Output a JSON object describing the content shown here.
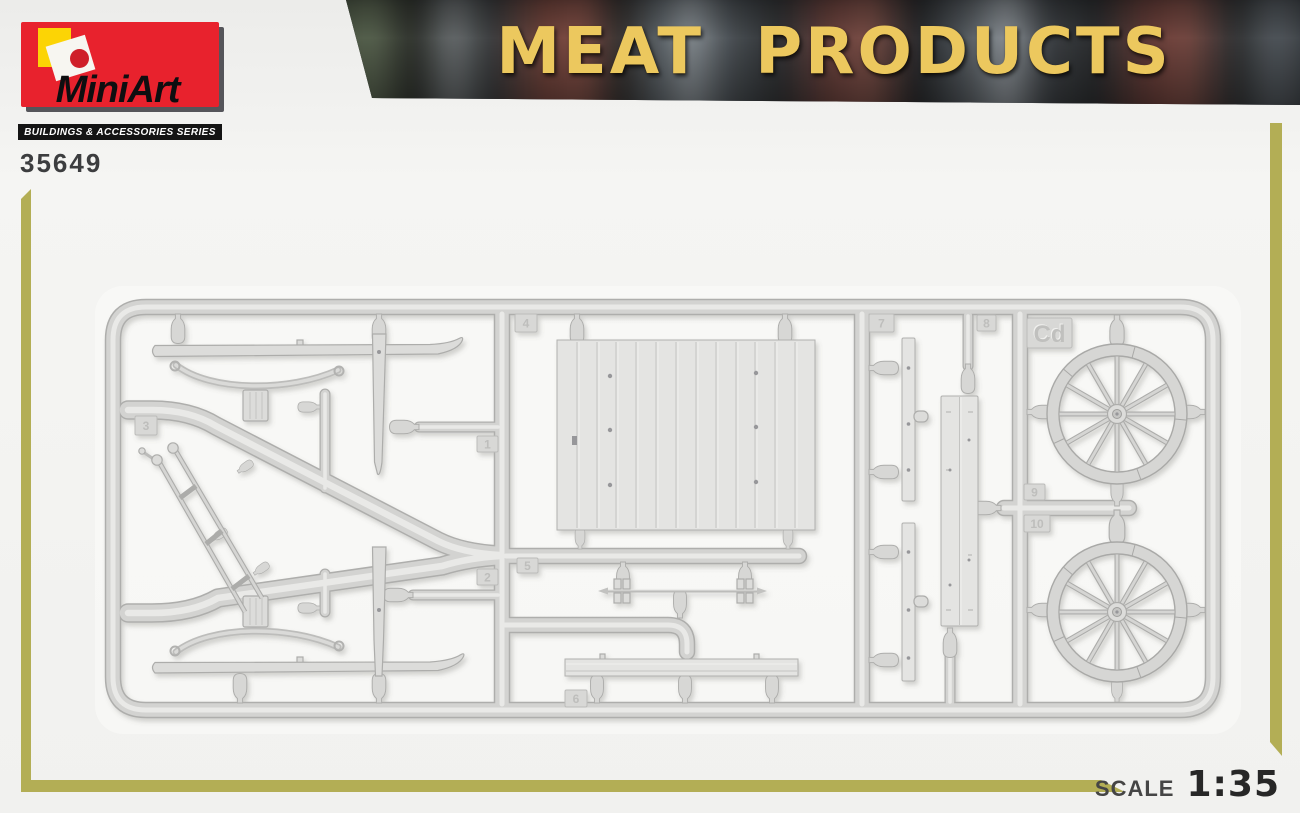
{
  "brand": {
    "name": "MiniArt",
    "series": "BUILDINGS & ACCESSORIES SERIES",
    "product_number": "35649"
  },
  "title": {
    "text": "MEAT PRODUCTS"
  },
  "scale": {
    "label": "SCALE",
    "value": "1:35"
  },
  "sprue": {
    "code": "Cd",
    "part_tags": [
      {
        "label": "1"
      },
      {
        "label": "2"
      },
      {
        "label": "3"
      },
      {
        "label": "4"
      },
      {
        "label": "5"
      },
      {
        "label": "6"
      },
      {
        "label": "7"
      },
      {
        "label": "8"
      },
      {
        "label": "9"
      },
      {
        "label": "10"
      }
    ]
  },
  "colors": {
    "accent_olive": "#b3ae55",
    "brand_red": "#e8222d",
    "logo_yellow": "#fcd405",
    "title_yellow": "#ecc85e",
    "sprue_gray": "#d3d3d1"
  }
}
